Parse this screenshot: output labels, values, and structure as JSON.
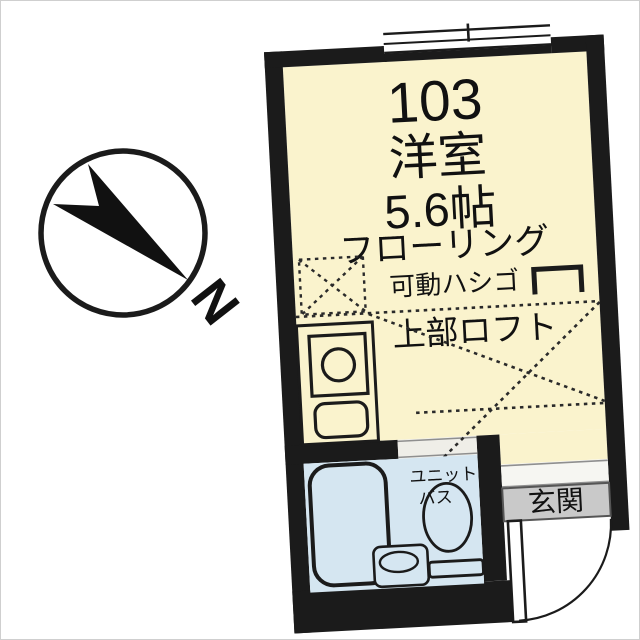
{
  "plan": {
    "room_number": "103",
    "room_type": "洋室",
    "room_size": "5.6帖",
    "flooring_label": "フローリング",
    "ladder_label": "可動ハシゴ",
    "loft_label": "上部ロフト",
    "unit_bath_label_line1": "ユニット",
    "unit_bath_label_line2": "バス",
    "entrance_label": "玄関"
  },
  "compass": {
    "north_label": "N"
  },
  "colors": {
    "room_fill": "#FAF3CD",
    "fixture_fill": "#D5E6F1",
    "entrance_fill": "#C9C9C9",
    "wall_color": "#1B1B1B",
    "line_color": "#2A2A2A"
  }
}
